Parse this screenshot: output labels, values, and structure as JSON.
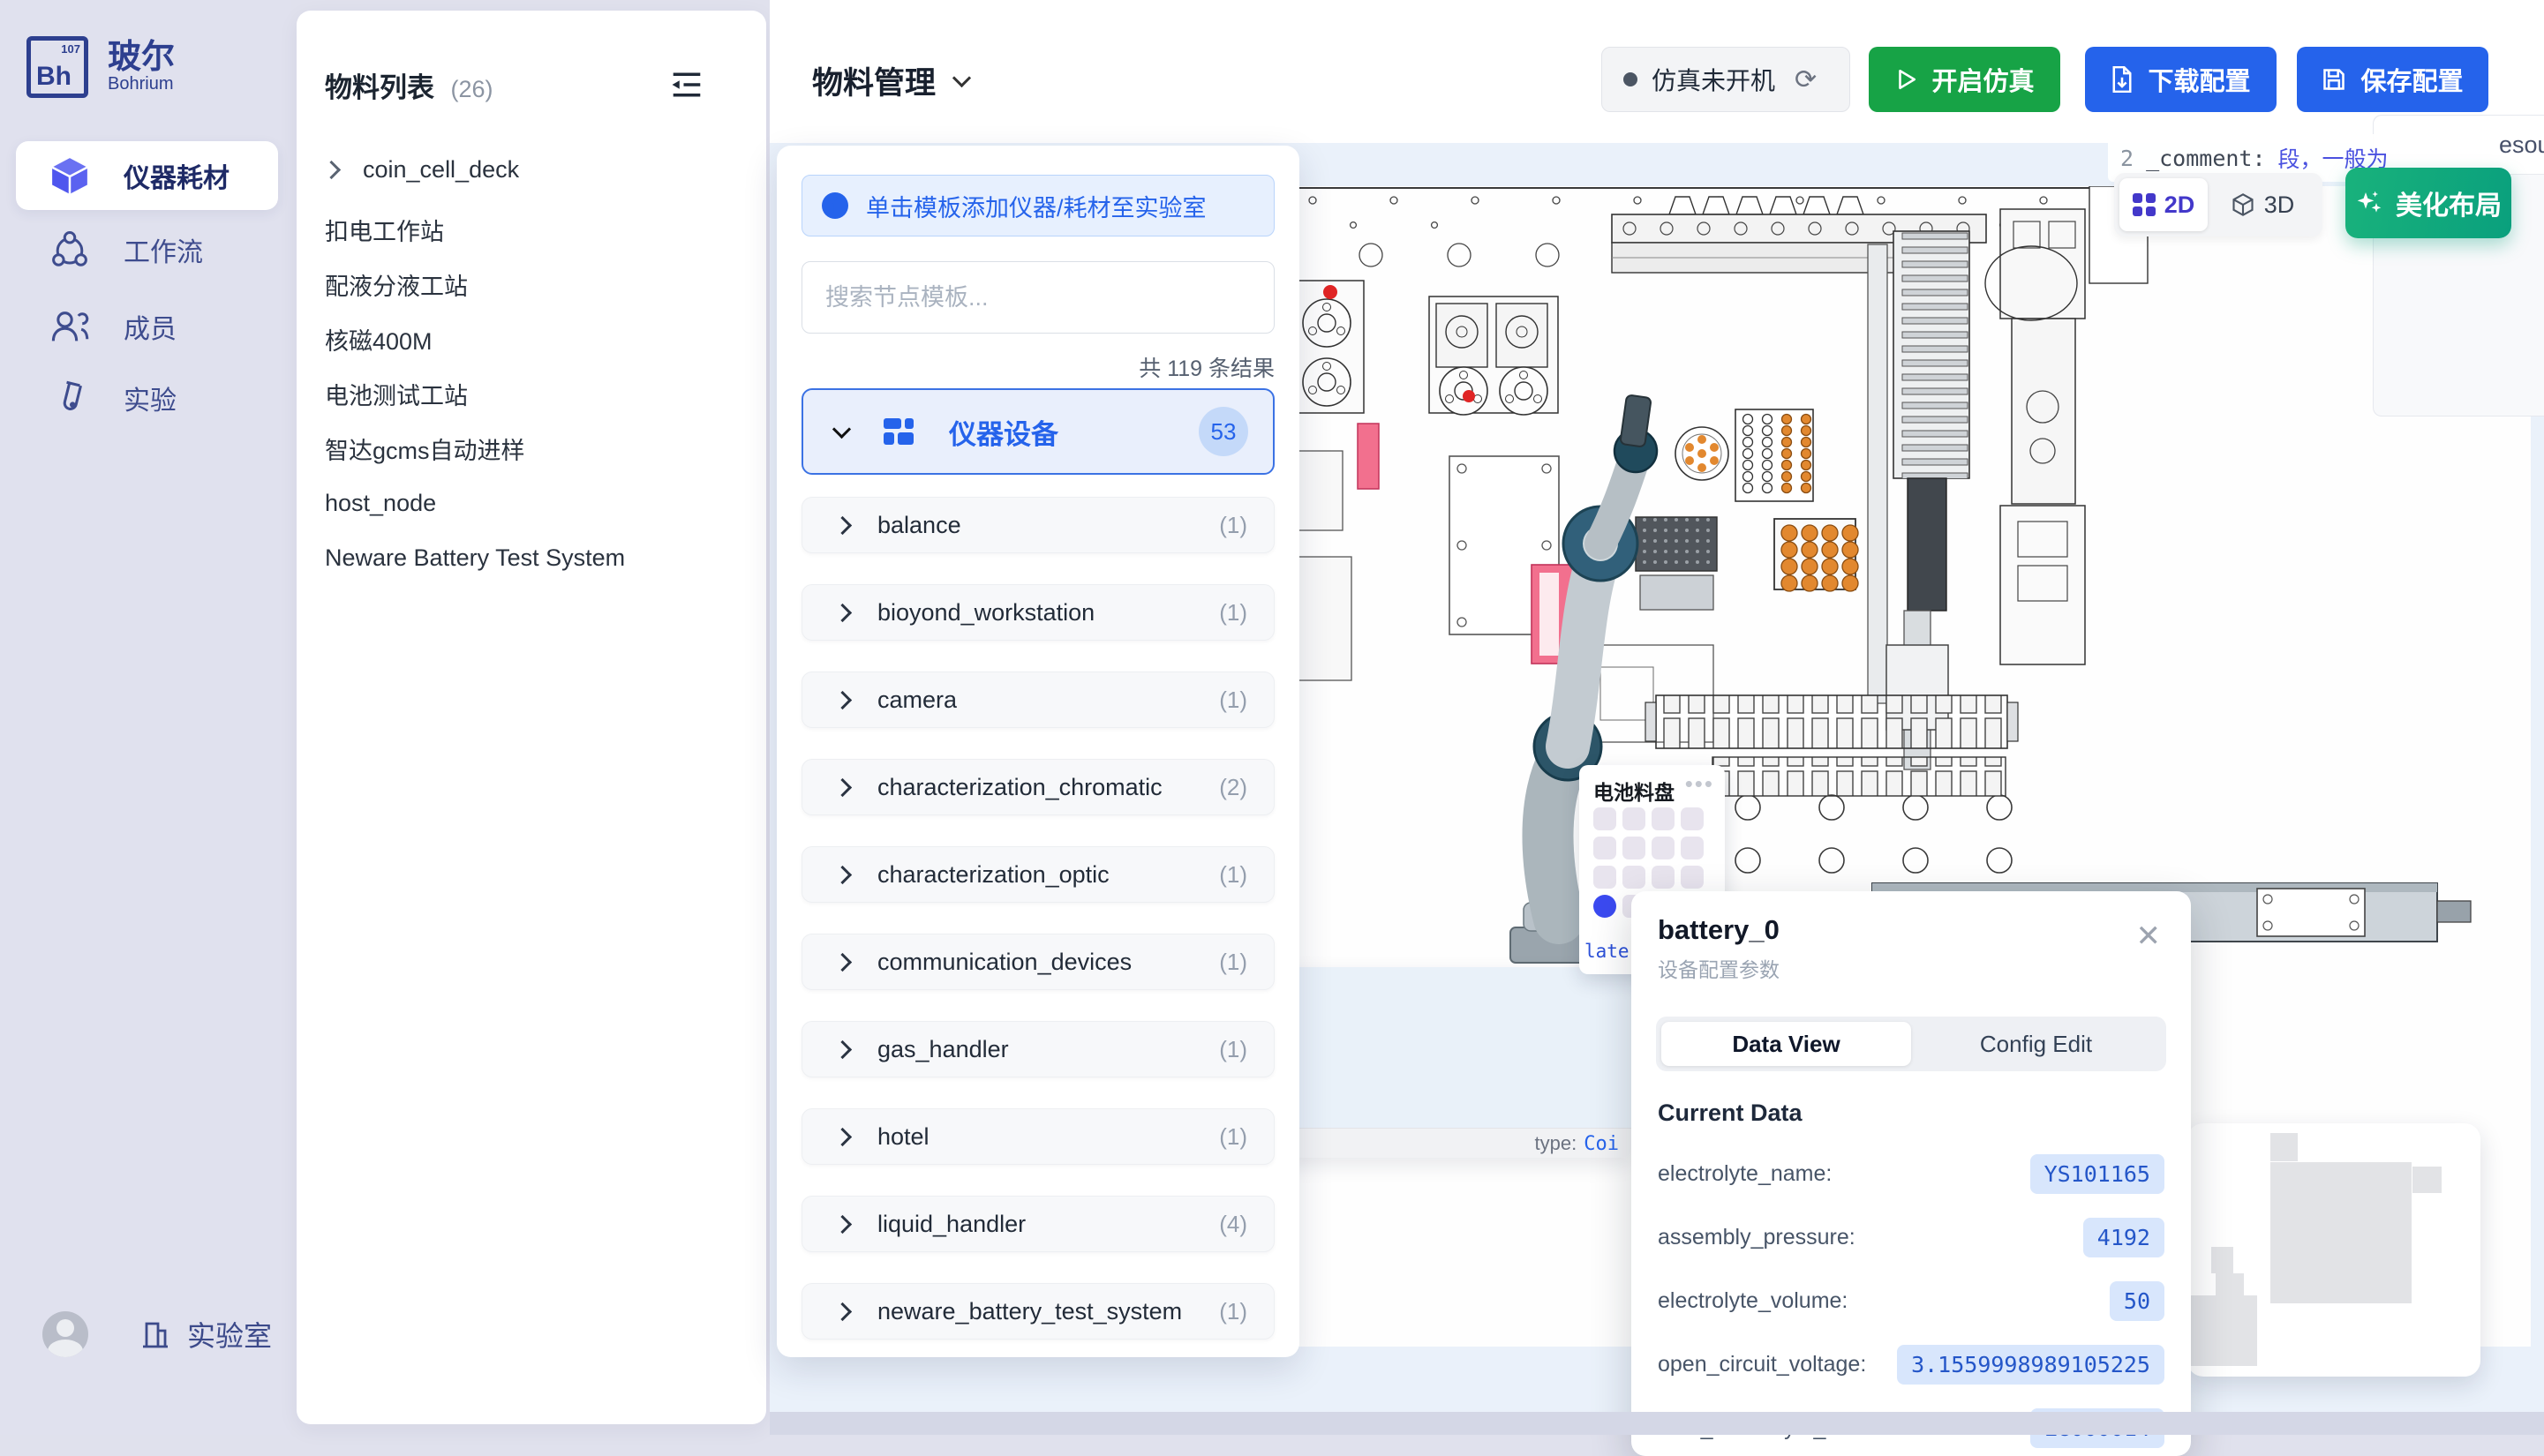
{
  "sidebar": {
    "brand": {
      "logo_text": "Bh",
      "logo_sup": "107",
      "name_zh": "玻尔",
      "name_en": "Bohrium"
    },
    "items": [
      {
        "label": "仪器耗材",
        "icon": "cube-icon",
        "active": true
      },
      {
        "label": "工作流",
        "icon": "workflow-icon",
        "active": false
      },
      {
        "label": "成员",
        "icon": "members-icon",
        "active": false
      },
      {
        "label": "实验",
        "icon": "experiment-icon",
        "active": false
      }
    ],
    "footer": {
      "lab_label": "实验室"
    }
  },
  "materials_panel": {
    "title": "物料列表",
    "count": "(26)",
    "items": [
      {
        "label": "coin_cell_deck",
        "expandable": true
      },
      {
        "label": "扣电工作站"
      },
      {
        "label": "配液分液工站"
      },
      {
        "label": "核磁400M"
      },
      {
        "label": "电池测试工站"
      },
      {
        "label": "智达gcms自动进样"
      },
      {
        "label": "host_node"
      },
      {
        "label": "Neware Battery Test System"
      }
    ]
  },
  "header": {
    "title": "物料管理",
    "status_label": "仿真未开机",
    "start_sim_label": "开启仿真",
    "download_label": "下载配置",
    "save_label": "保存配置"
  },
  "template_panel": {
    "banner": "单击模板添加仪器/耗材至实验室",
    "search_placeholder": "搜索节点模板...",
    "result_count": "共 119 条结果",
    "category": {
      "label": "仪器设备",
      "count": "53"
    },
    "items": [
      {
        "label": "balance",
        "count": "(1)"
      },
      {
        "label": "bioyond_workstation",
        "count": "(1)"
      },
      {
        "label": "camera",
        "count": "(1)"
      },
      {
        "label": "characterization_chromatic",
        "count": "(2)"
      },
      {
        "label": "characterization_optic",
        "count": "(1)"
      },
      {
        "label": "communication_devices",
        "count": "(1)"
      },
      {
        "label": "gas_handler",
        "count": "(1)"
      },
      {
        "label": "hotel",
        "count": "(1)"
      },
      {
        "label": "liquid_handler",
        "count": "(4)"
      },
      {
        "label": "neware_battery_test_system",
        "count": "(1)"
      }
    ]
  },
  "canvas": {
    "comment_tip": {
      "line": "2",
      "key": "_comment:",
      "value": "段，一般为空，stat"
    },
    "view_toggle": {
      "d2": "2D",
      "d3": "3D"
    },
    "beautify_label": "美化布局",
    "side_panel_text": "esou",
    "tray": {
      "title": "电池料盘",
      "more": "•••",
      "footer": "late"
    },
    "type_tooltip": {
      "key": "type:",
      "value": "Coi"
    }
  },
  "battery_card": {
    "title": "battery_0",
    "subtitle": "设备配置参数",
    "close": "✕",
    "tabs": [
      "Data View",
      "Config Edit"
    ],
    "section": "Current Data",
    "rows": [
      {
        "label": "electrolyte_name:",
        "value": "YS101165"
      },
      {
        "label": "assembly_pressure:",
        "value": "4192"
      },
      {
        "label": "electrolyte_volume:",
        "value": "50"
      },
      {
        "label": "open_circuit_voltage:",
        "value": "3.1559998989105225"
      },
      {
        "label": "data_electrolyte_code:",
        "value": "LG000014"
      }
    ]
  },
  "colors": {
    "accent_blue": "#2563eb",
    "green": "#17a346",
    "teal": "#0aa07d",
    "indigo": "#4338ca",
    "pill_bg": "#d8e6fc",
    "pill_text": "#2456c8",
    "sidebar_bg": "#e0e1ee",
    "canvas_bg": "#eaf1fa"
  }
}
